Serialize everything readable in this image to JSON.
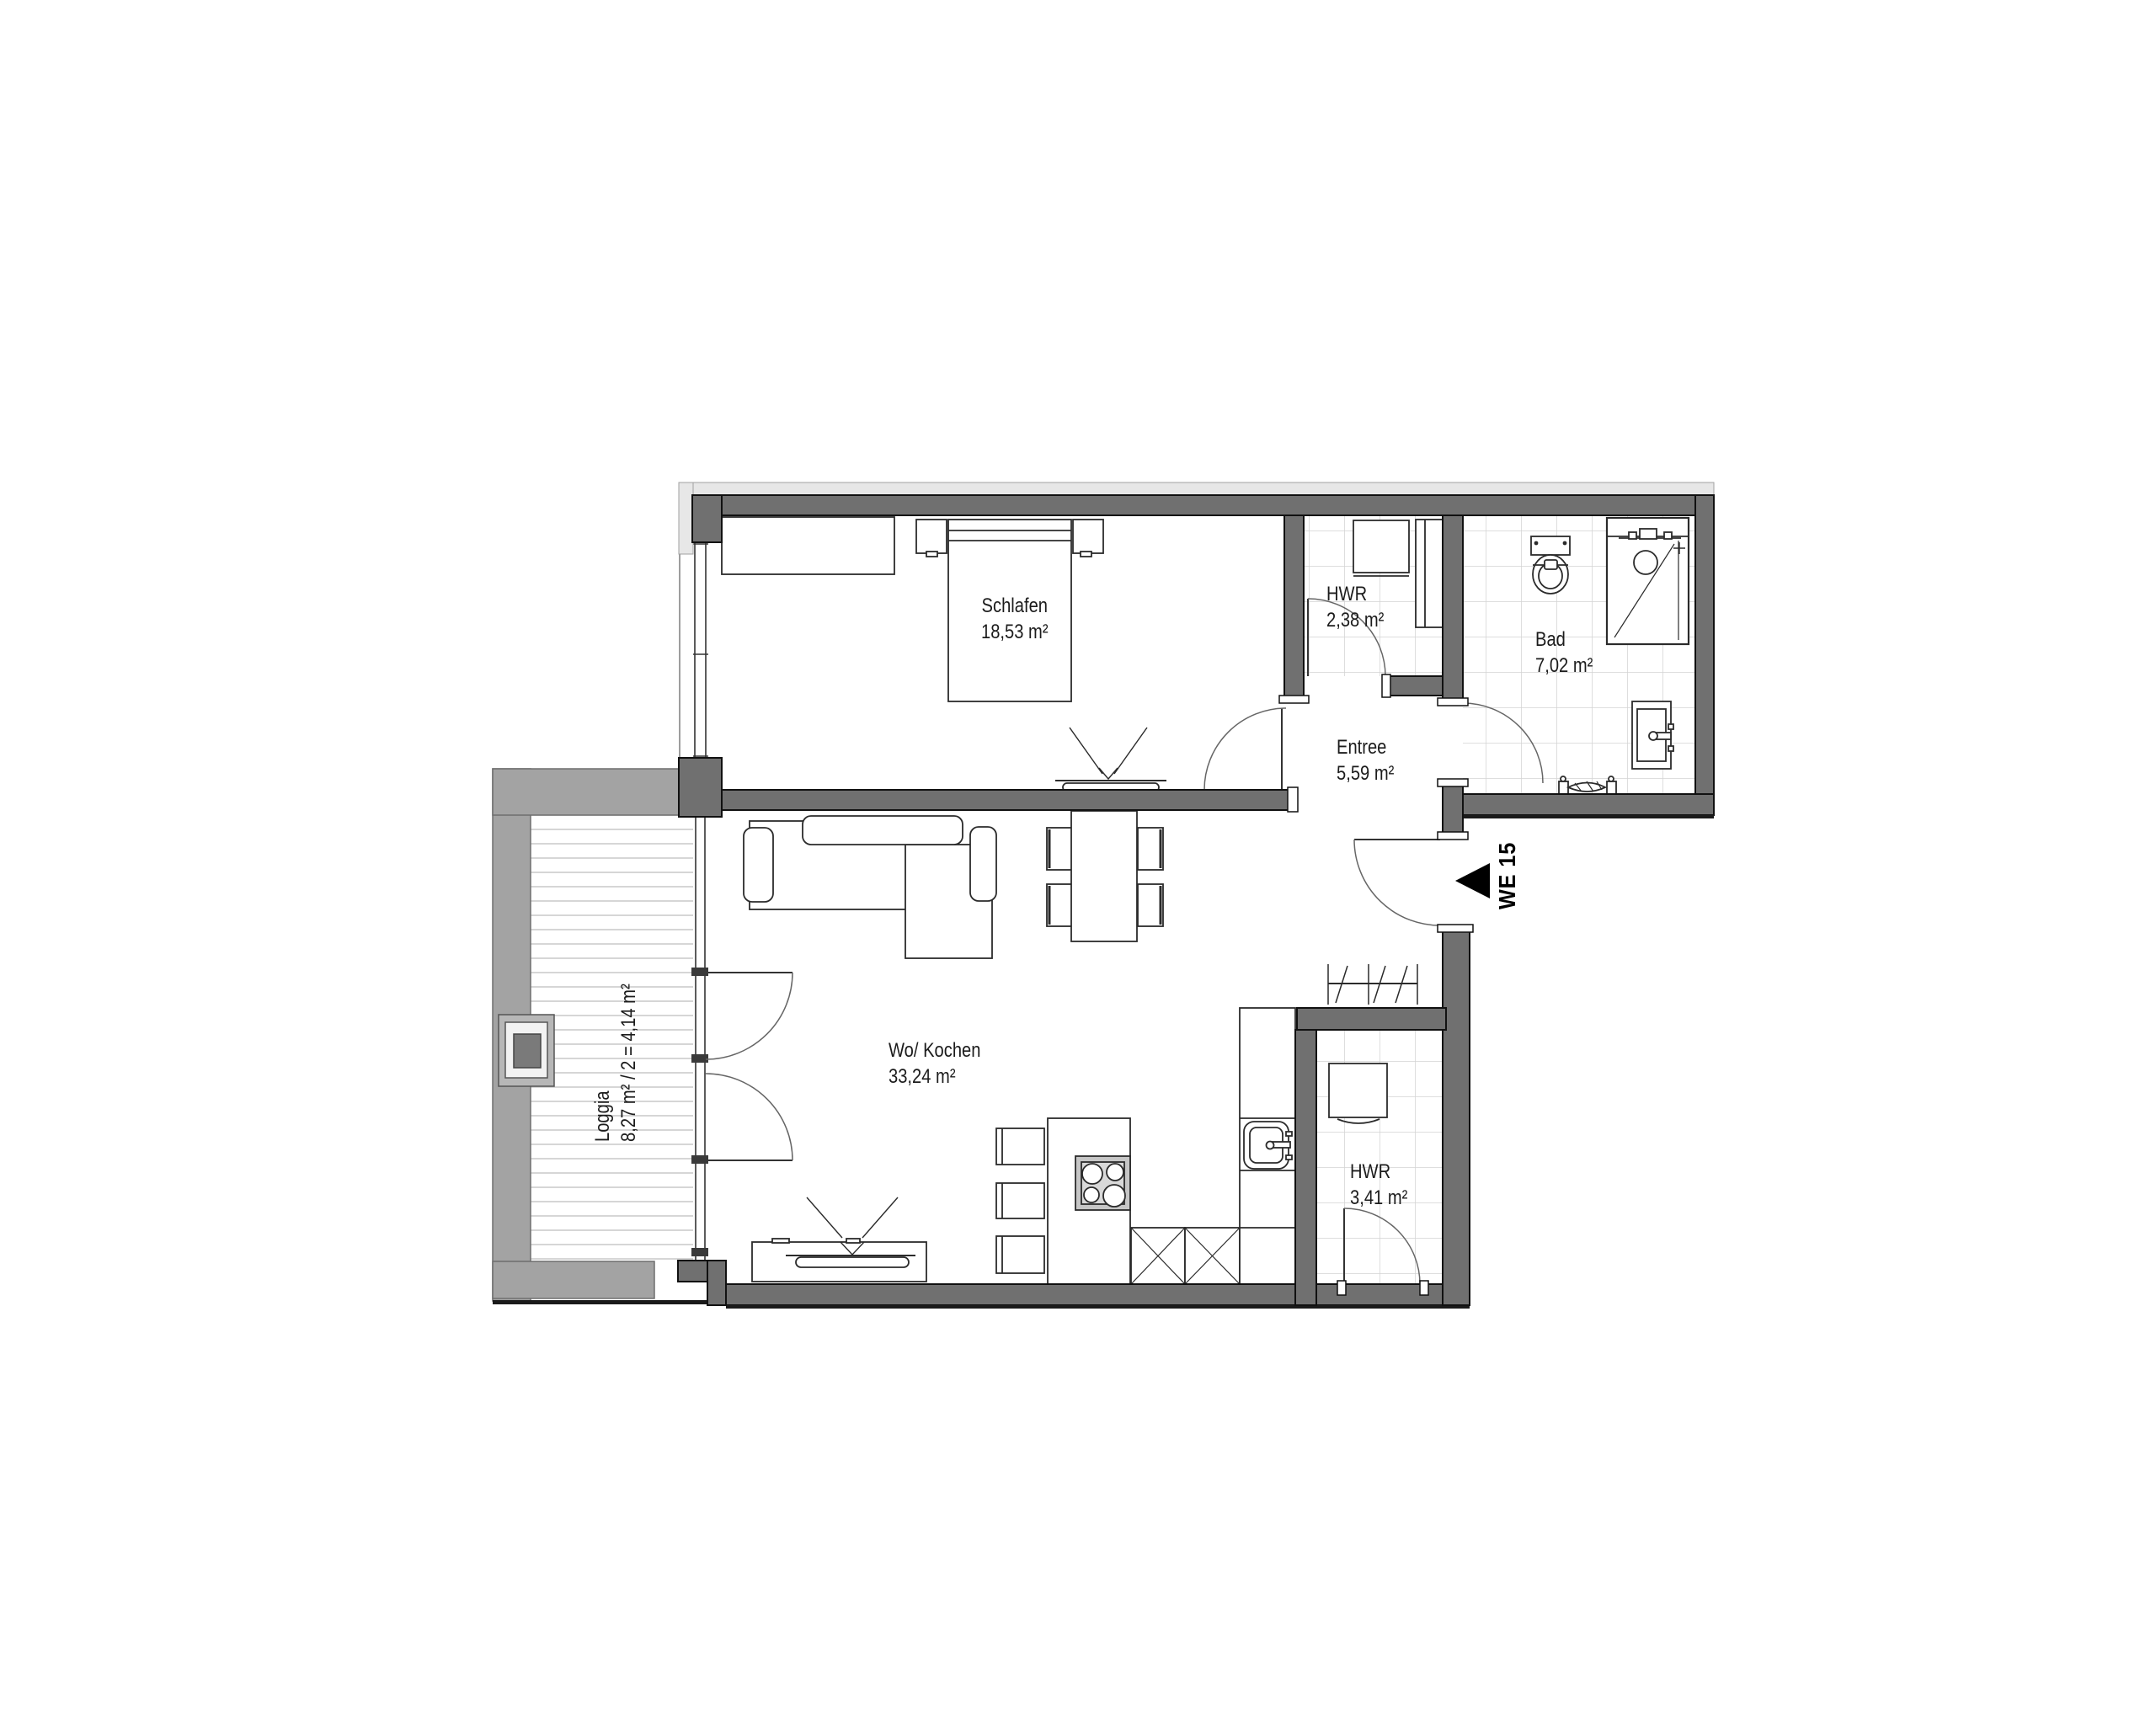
{
  "plan": {
    "unit_label": "WE 15",
    "rooms": {
      "schlafen": {
        "name": "Schlafen",
        "area": "18,53 m²"
      },
      "hwr_oben": {
        "name": "HWR",
        "area": "2,38 m²"
      },
      "bad": {
        "name": "Bad",
        "area": "7,02 m²"
      },
      "entree": {
        "name": "Entree",
        "area": "5,59 m²"
      },
      "wohnen": {
        "name": "Wo/ Kochen",
        "area": "33,24 m²"
      },
      "hwr_unten": {
        "name": "HWR",
        "area": "3,41 m²"
      },
      "loggia": {
        "name": "Loggia",
        "area": "8,27 m² / 2 = 4,14 m²"
      }
    },
    "colors": {
      "wall": "#707070",
      "loggia_wall": "#a3a3a3",
      "insulation": "#e7e7e7",
      "tile_line": "#d4d4d4",
      "deck_line": "#c9c9c9",
      "stove_gray": "#c6c6c6",
      "text": "#1c1c1c"
    }
  }
}
